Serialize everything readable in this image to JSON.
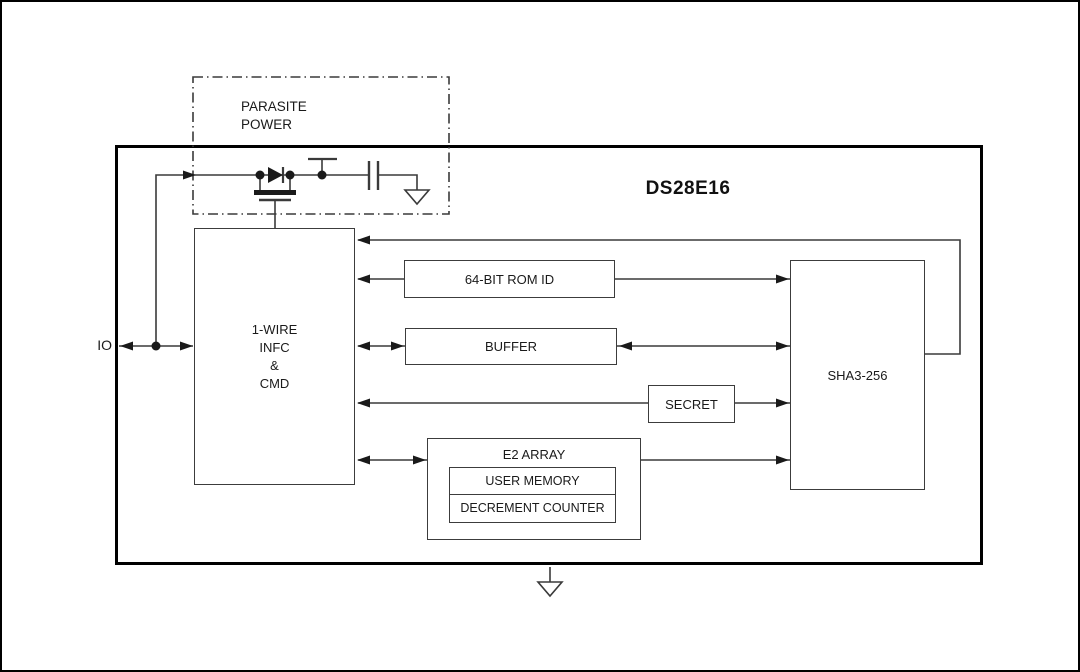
{
  "chip": {
    "name": "DS28E16"
  },
  "labels": {
    "io_pin": "IO"
  },
  "parasite_power": {
    "title": "PARASITE\nPOWER"
  },
  "blocks": {
    "one_wire": {
      "lines": [
        "1-WIRE",
        "INFC",
        "&",
        "CMD"
      ]
    },
    "rom_id": {
      "label": "64-BIT ROM ID"
    },
    "buffer": {
      "label": "BUFFER"
    },
    "secret": {
      "label": "SECRET"
    },
    "e2_array": {
      "title": "E2 ARRAY",
      "rows": [
        "USER MEMORY",
        "DECREMENT COUNTER"
      ]
    },
    "sha3": {
      "label": "SHA3-256"
    }
  },
  "colors": {
    "background": "#ffffff",
    "outer_border": "#000000",
    "main_block_border": "#000000",
    "thin_line": "#3a3a3a",
    "box_border": "#3c3c3c",
    "text": "#1a1a1a",
    "arrow_fill": "#1a1a1a"
  }
}
